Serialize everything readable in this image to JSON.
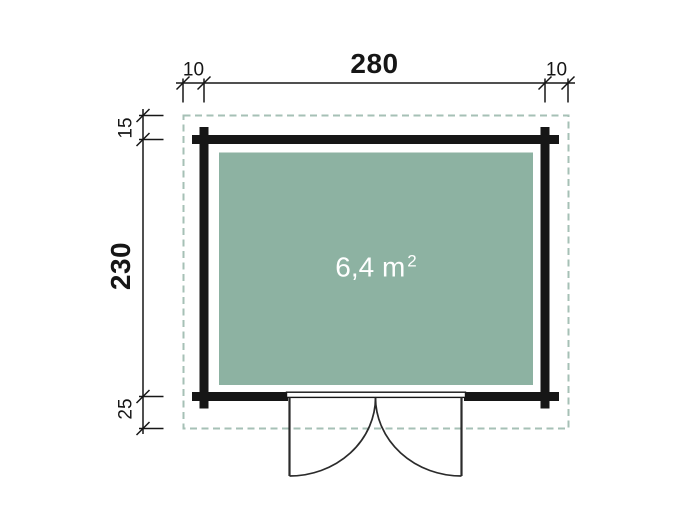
{
  "plan": {
    "area": {
      "value": "6,4 m",
      "exponent": "2"
    },
    "dimensions": {
      "top_left_overhang": "10",
      "top_width": "280",
      "top_right_overhang": "10",
      "left_top_overhang": "15",
      "left_depth": "230",
      "left_bottom_overhang": "25"
    }
  },
  "colors": {
    "interior": "#8db2a2",
    "roof-dash": "#a6c0b6",
    "line": "#161616",
    "door-line": "#2b2b2b",
    "area-text": "#ffffff",
    "background": "#ffffff"
  }
}
